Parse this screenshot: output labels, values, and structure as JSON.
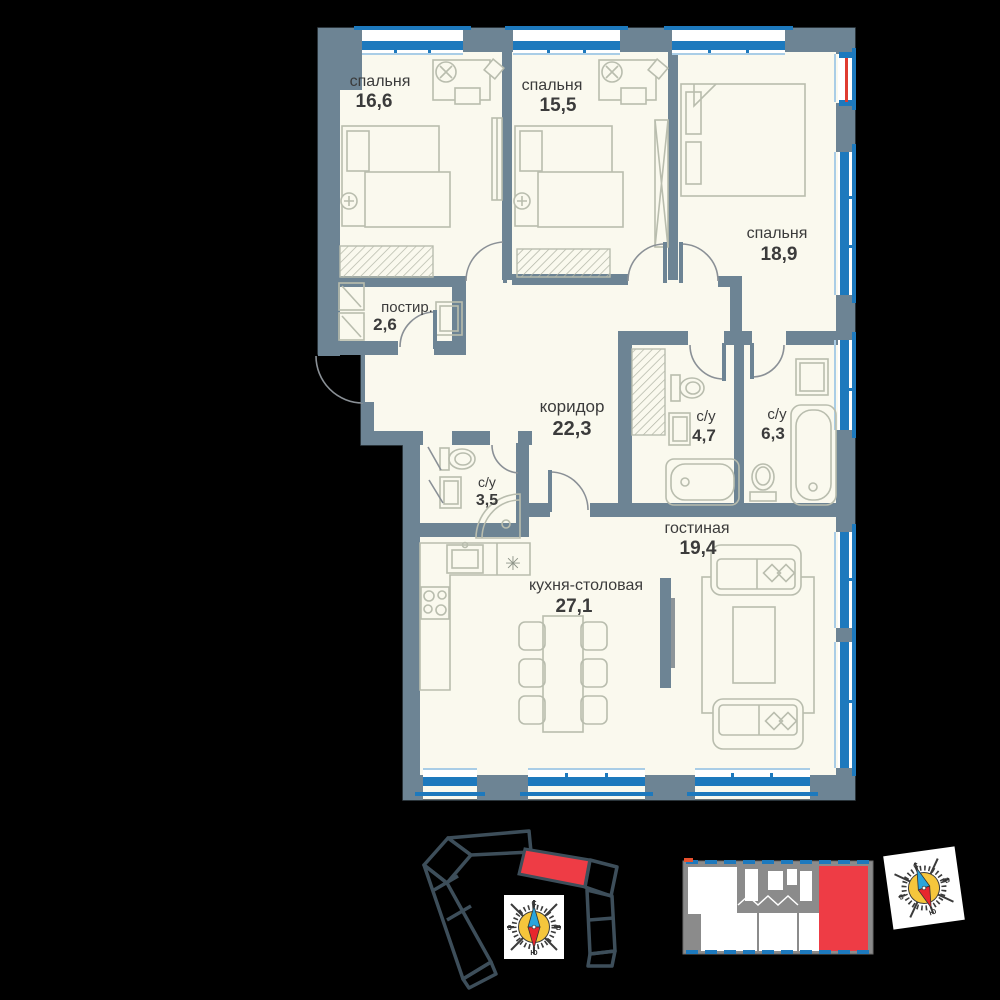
{
  "plan": {
    "rooms": [
      {
        "id": "bedroom-1",
        "name": "спальня",
        "area": "16,6"
      },
      {
        "id": "bedroom-2",
        "name": "спальня",
        "area": "15,5"
      },
      {
        "id": "bedroom-3",
        "name": "спальня",
        "area": "18,9"
      },
      {
        "id": "laundry",
        "name": "постир.",
        "area": "2,6"
      },
      {
        "id": "corridor",
        "name": "коридор",
        "area": "22,3"
      },
      {
        "id": "bathroom-1",
        "name": "с/у",
        "area": "4,7"
      },
      {
        "id": "bathroom-2",
        "name": "с/у",
        "area": "6,3"
      },
      {
        "id": "bathroom-3",
        "name": "с/у",
        "area": "3,5"
      },
      {
        "id": "living",
        "name": "гостиная",
        "area": "19,4"
      },
      {
        "id": "kitchen",
        "name": "кухня-столовая",
        "area": "27,1"
      }
    ],
    "symbols": {
      "dishwasher": "✳"
    }
  },
  "compass": {
    "north": "С",
    "south": "Ю",
    "east": "В",
    "west": "З"
  },
  "colors": {
    "background": "#000000",
    "wall": "#6d8494",
    "window_blue": "#1d79bd",
    "room_fill": "#faf9ee",
    "furniture": "#b9bdae",
    "highlight_red": "#ee3c45",
    "balcony_red": "#e03c31",
    "minimap_outline": "#3d4e5a",
    "minimap_gray": "#8b8b8b",
    "compass_yellow": "#f5c63c",
    "compass_blue": "#2aa5dc",
    "compass_red": "#e8272d"
  }
}
